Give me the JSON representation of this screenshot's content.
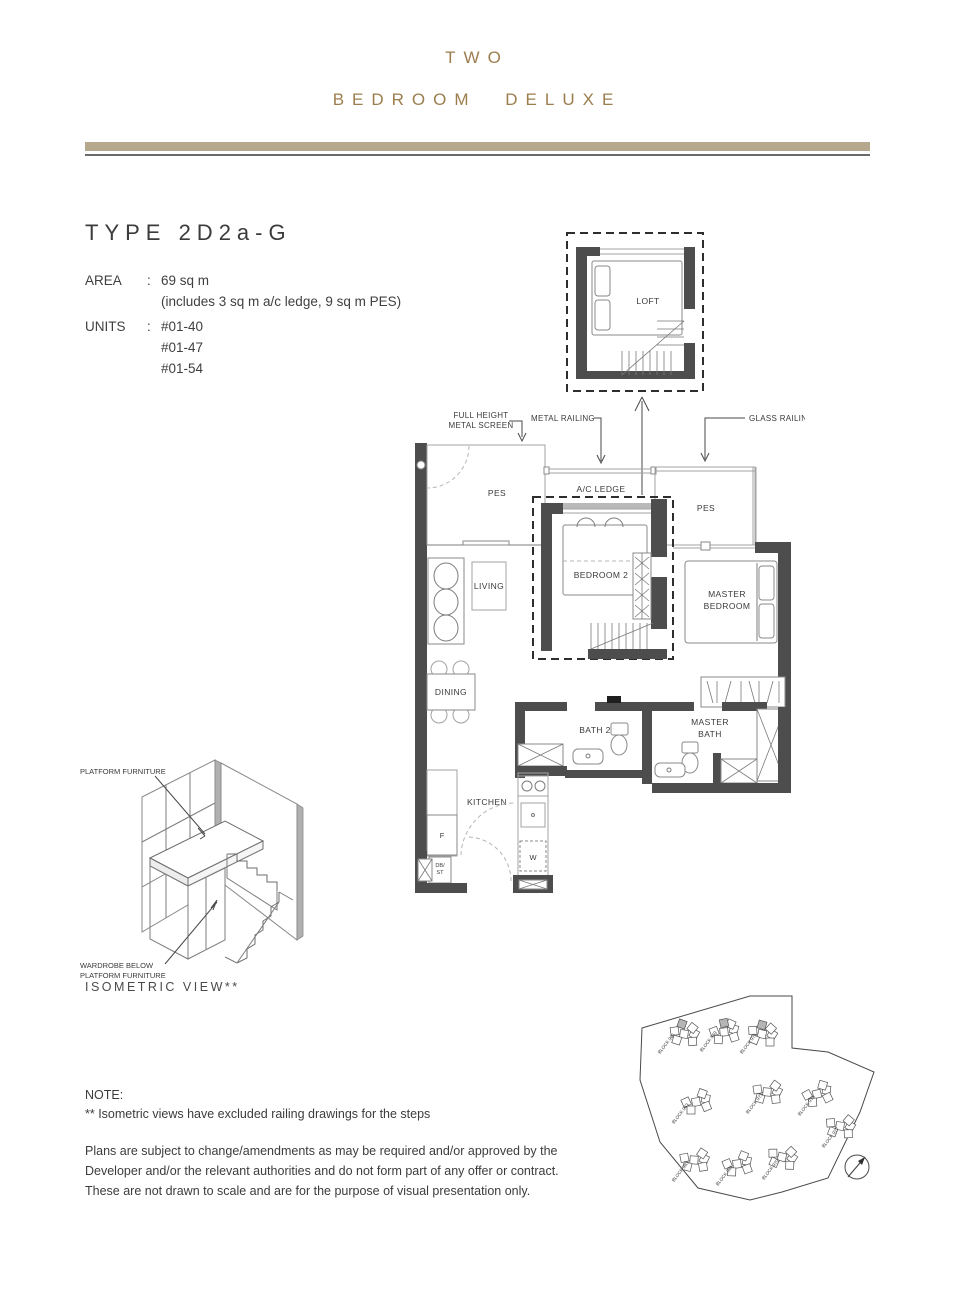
{
  "page": {
    "title_line1": "TWO",
    "title_line2": "BEDROOM DELUXE",
    "type_heading": "TYPE 2D2a-G",
    "specs": {
      "area_label": "AREA",
      "colon": ":",
      "area_value": "69 sq m",
      "area_note": "(includes 3 sq m a/c ledge, 9 sq m PES)",
      "units_label": "UNITS",
      "units": [
        "#01-40",
        "#01-47",
        "#01-54"
      ]
    },
    "note": {
      "heading": "NOTE:",
      "line1": "** Isometric views have excluded railing drawings for the steps",
      "disclaimer": "Plans are subject to change/amendments as may be required and/or approved by the Developer and/or the relevant authorities and do not form part of any offer or contract. These are not drawn to scale and are for the purpose of visual presentation only."
    },
    "colors": {
      "accent_gold": "#9c7e4e",
      "divider_tan": "#b5a88c",
      "wall_gray": "#4d4d4d"
    }
  },
  "floorplan": {
    "labels": {
      "loft": "LOFT",
      "full_height_1": "FULL HEIGHT",
      "full_height_2": "METAL SCREEN",
      "metal_railing": "METAL RAILING",
      "glass_railing": "GLASS RAILING",
      "pes_left": "PES",
      "ac_ledge": "A/C LEDGE",
      "pes_right": "PES",
      "bedroom2": "BEDROOM 2",
      "master1": "MASTER",
      "master2": "BEDROOM",
      "living": "LIVING",
      "dining": "DINING",
      "bath2": "BATH 2",
      "mbath1": "MASTER",
      "mbath2": "BATH",
      "kitchen": "KITCHEN",
      "fridge": "F",
      "db": "DB/",
      "st": "ST",
      "washer": "W"
    }
  },
  "isometric": {
    "platform_label": "PLATFORM FURNITURE",
    "wardrobe_label_1": "WARDROBE BELOW",
    "wardrobe_label_2": "PLATFORM FURNITURE",
    "caption": "ISOMETRIC VIEW**"
  },
  "siteplan": {
    "blocks": [
      "BLOCK 965",
      "BLOCK 969",
      "BLOCK 971",
      "BLOCK 963",
      "BLOCK 973",
      "BLOCK 975",
      "BLOCK 977",
      "BLOCK 983",
      "BLOCK 981",
      "BLOCK 979"
    ]
  }
}
